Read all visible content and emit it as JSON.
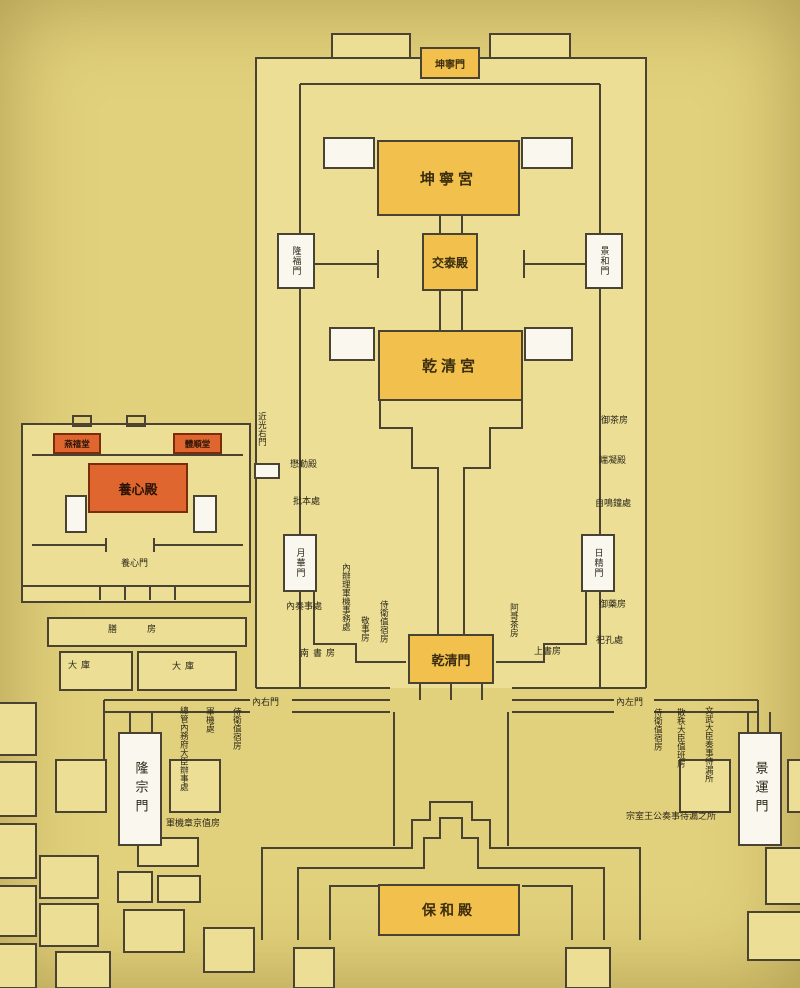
{
  "plan": {
    "halls": [
      {
        "id": "kunning-gate",
        "label": "坤寧門"
      },
      {
        "id": "kunning-palace",
        "label": "坤寧宮"
      },
      {
        "id": "jiaotai-hall",
        "label": "交泰殿"
      },
      {
        "id": "qianqing-palace",
        "label": "乾清宮"
      },
      {
        "id": "qianqing-gate",
        "label": "乾清門"
      },
      {
        "id": "baohe-hall",
        "label": "保和殿"
      },
      {
        "id": "yangxin-hall",
        "label": "養心殿"
      },
      {
        "id": "yanxi-hall",
        "label": "燕禧堂"
      },
      {
        "id": "tishun-hall",
        "label": "體順堂"
      }
    ],
    "gates": [
      {
        "id": "longfu-gate",
        "label": "隆福門"
      },
      {
        "id": "jinghe-gate",
        "label": "景和門"
      },
      {
        "id": "yuehua-gate",
        "label": "月華門"
      },
      {
        "id": "rijing-gate",
        "label": "日精門"
      },
      {
        "id": "longzong-gate",
        "label": "隆宗門"
      },
      {
        "id": "jingyun-gate",
        "label": "景運門"
      }
    ],
    "labels": [
      {
        "id": "jinguang-right-gate",
        "text": "近光右門"
      },
      {
        "id": "maoqin-hall",
        "text": "懋勤殿"
      },
      {
        "id": "piben-office",
        "text": "批本處"
      },
      {
        "id": "imperial-tea-room",
        "text": "御茶房"
      },
      {
        "id": "duanning-hall",
        "text": "端凝殿"
      },
      {
        "id": "chime-clock-office",
        "text": "自鳴鐘處"
      },
      {
        "id": "inner-memorial-office",
        "text": "內奏事處"
      },
      {
        "id": "military-affairs-office",
        "text": "內辦理軍機事務處"
      },
      {
        "id": "jingshi-room",
        "text": "敬事房"
      },
      {
        "id": "guard-room-north",
        "text": "侍衛值宿房"
      },
      {
        "id": "south-study",
        "text": "南書房"
      },
      {
        "id": "age-tea-room",
        "text": "阿哥茶房"
      },
      {
        "id": "upper-study",
        "text": "上書房"
      },
      {
        "id": "imperial-pharmacy",
        "text": "御藥房"
      },
      {
        "id": "sikong-office",
        "text": "祀孔處"
      },
      {
        "id": "yangxin-gate",
        "text": "養心門"
      },
      {
        "id": "imperial-kitchen",
        "text": "膳房"
      },
      {
        "id": "storehouse-west",
        "text": "大庫"
      },
      {
        "id": "storehouse-east",
        "text": "大庫"
      },
      {
        "id": "inner-right-gate",
        "text": "內右門"
      },
      {
        "id": "inner-left-gate",
        "text": "內左門"
      },
      {
        "id": "household-dept-office",
        "text": "總管內務府大臣辦事處"
      },
      {
        "id": "junji-office",
        "text": "軍機處"
      },
      {
        "id": "guard-room-west",
        "text": "侍衛值宿房"
      },
      {
        "id": "junji-clerks-room",
        "text": "軍機章京值房"
      },
      {
        "id": "guard-room-east",
        "text": "侍衛值宿房"
      },
      {
        "id": "sanzhi-ministers-room",
        "text": "散秩大臣值班房"
      },
      {
        "id": "civil-military-waiting",
        "text": "文武大臣奏事待漏所"
      },
      {
        "id": "clan-princes-waiting",
        "text": "宗室王公奏事待漏之所"
      }
    ],
    "colors": {
      "background": "#e2d17c",
      "courtyard": "#ecdf95",
      "wall": "#4a4334",
      "hall_orange": "#f2c04d",
      "hall_red": "#e0662f",
      "gate_white": "#f9f7ee"
    }
  }
}
